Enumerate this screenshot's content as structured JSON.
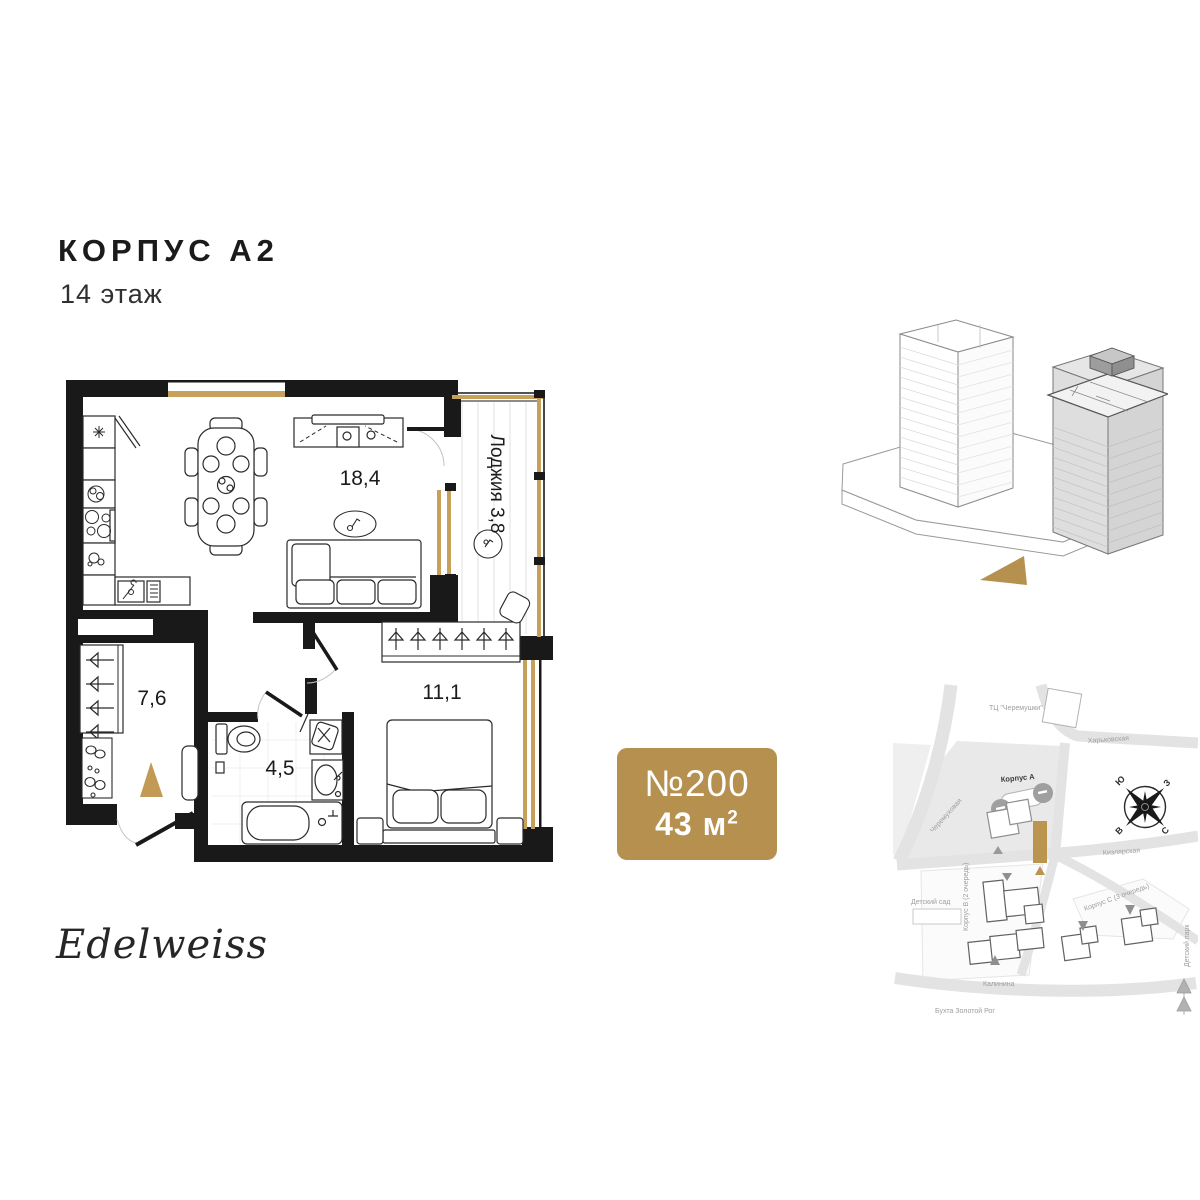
{
  "header": {
    "title": "КОРПУС А2",
    "subtitle": "14 этаж"
  },
  "floor_plan": {
    "rooms": [
      {
        "name": "kitchen-living",
        "area": "18,4"
      },
      {
        "name": "hallway",
        "area": "7,6"
      },
      {
        "name": "bathroom",
        "area": "4,5"
      },
      {
        "name": "bedroom",
        "area": "11,1"
      },
      {
        "name": "loggia",
        "label": "Лоджия 3,8"
      }
    ],
    "colors": {
      "wall": "#191919",
      "window_gold": "#c7a05c",
      "entrance_gold": "#c29a56"
    }
  },
  "badge": {
    "number": "№200",
    "area": "43 м",
    "area_exponent": "2",
    "color": "#b5904e"
  },
  "building_3d": {
    "highlight_color": "#b5904e"
  },
  "map": {
    "labels": {
      "mall": "ТЦ \"Черемушки\"",
      "street_kharkovskaya": "Харьковская",
      "street_cheryomukhovaya": "Черемуховая",
      "korpus_a": "Корпус А",
      "street_kizlyarskaya": "Кизлярская",
      "kindergarten": "Детский сад",
      "korpus_b": "Корпус В (2 очередь)",
      "korpus_c": "Корпус С (3 очередь)",
      "street_kalinina": "Калинина",
      "bay": "Бухта Золотой Рог",
      "park": "Детский парк"
    },
    "compass": {
      "south": "Ю",
      "west": "З",
      "east": "В",
      "north": "С"
    },
    "highlight_color": "#bb9450"
  },
  "logo": {
    "text": "Edelweiss"
  }
}
